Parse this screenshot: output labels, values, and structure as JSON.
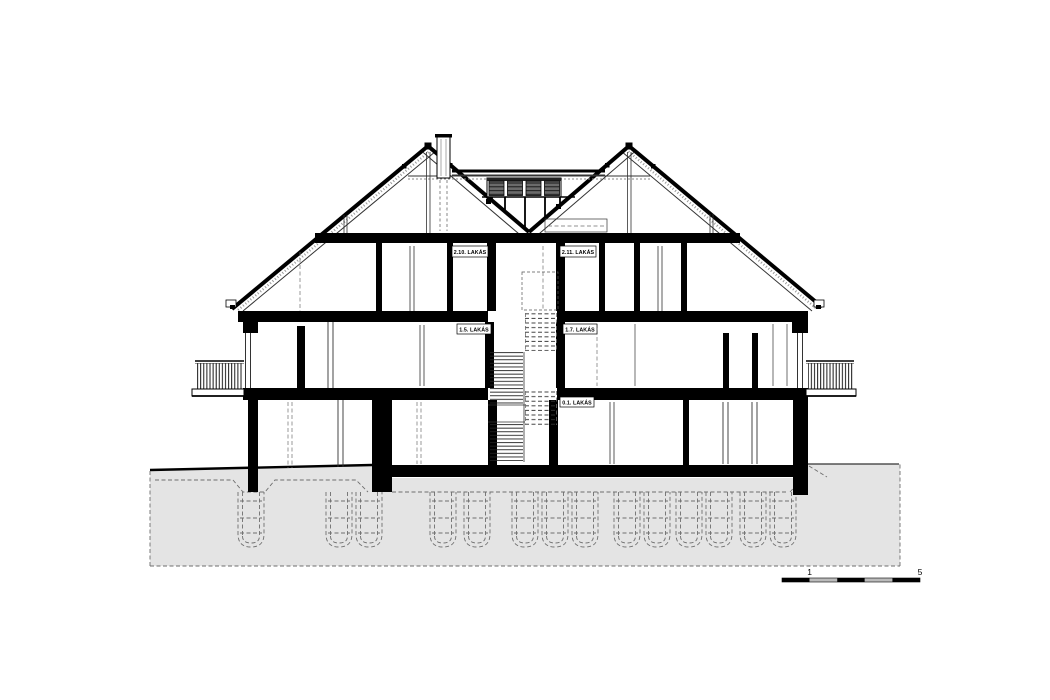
{
  "meta": {
    "type": "architectural-section-drawing"
  },
  "labels": {
    "apt_2_10": "2.10. LAKÁS",
    "apt_2_11": "2.11. LAKÁS",
    "apt_1_5": "1.5. LAKÁS",
    "apt_1_7": "1.7. LAKÁS",
    "apt_0_1": "0.1. LAKÁS"
  },
  "scale_bar": {
    "tick_mid": "1",
    "tick_end": "5"
  },
  "colors": {
    "ink": "#000000",
    "background": "#ffffff",
    "terrain_fill": "#e4e4e4",
    "dashed_gray": "#6e6e6e",
    "louver_gray": "#6b6b6b",
    "scale_light_segment": "#bbbbbb"
  }
}
